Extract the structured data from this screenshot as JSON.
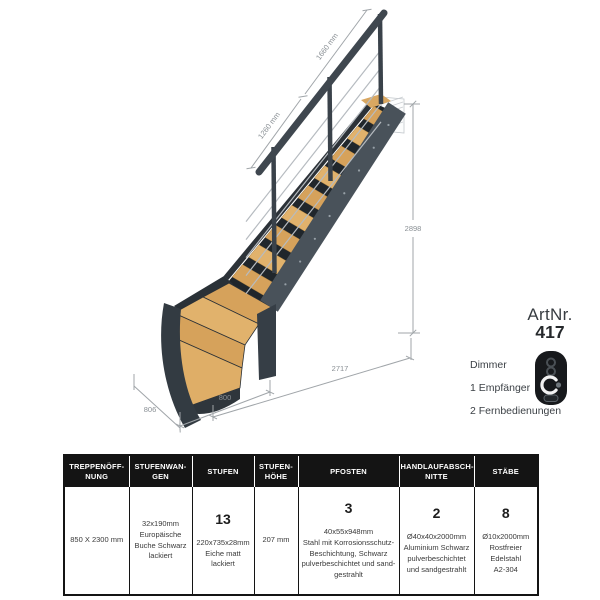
{
  "figure": {
    "description": "Quarter-turn staircase with wood treads, dark steel stringers, cable railing, wall mount",
    "dims": {
      "rail_upper": "1660 mm",
      "rail_lower": "1260 mm",
      "height": "2898",
      "run": "2717",
      "width_bottom": "800",
      "depth_left": "806"
    }
  },
  "artnr": {
    "label": "ArtNr.",
    "value": "417"
  },
  "accessories": {
    "dimmer": "Dimmer",
    "receiver": "1 Empfänger",
    "remotes": "2 Fernbedienungen",
    "icon": "remote-control-icon"
  },
  "table": {
    "columns": [
      {
        "header": "TREPPENÖFF-\nNUNG",
        "big": "",
        "body": "850 X 2300 mm"
      },
      {
        "header": "STUFENWAN-\nGEN",
        "big": "",
        "body": "32x190mm\nEuropäische\nBuche Schwarz\nlackiert"
      },
      {
        "header": "STUFEN",
        "big": "13",
        "body": "220x735x28mm\nEiche matt\nlackiert"
      },
      {
        "header": "STUFEN-\nHÖHE",
        "big": "",
        "body": "207 mm"
      },
      {
        "header": "PFOSTEN",
        "big": "3",
        "body": "40x55x948mm\nStahl mit Korrosionsschutz-\nBeschichtung, Schwarz\npulverbeschichtet und sand-\ngestrahlt"
      },
      {
        "header": "HANDLAUFABSCH-\nNITTE",
        "big": "2",
        "body": "Ø40x40x2000mm\nAluminium Schwarz\npulverbeschichtet\nund sandgestrahlt"
      },
      {
        "header": "STÄBE",
        "big": "8",
        "body": "Ø10x2000mm\nRostfreier\nEdelstahl\nA2-304"
      }
    ]
  },
  "colors": {
    "wood": "#d6a25b",
    "wood_light": "#e1b26c",
    "steel_dark": "#2c3238",
    "steel_mid": "#49525a",
    "steel_rail": "#3f474f",
    "cable": "#b6bbc0",
    "dim_line": "#a0a5a9",
    "table_header_bg": "#141414"
  }
}
